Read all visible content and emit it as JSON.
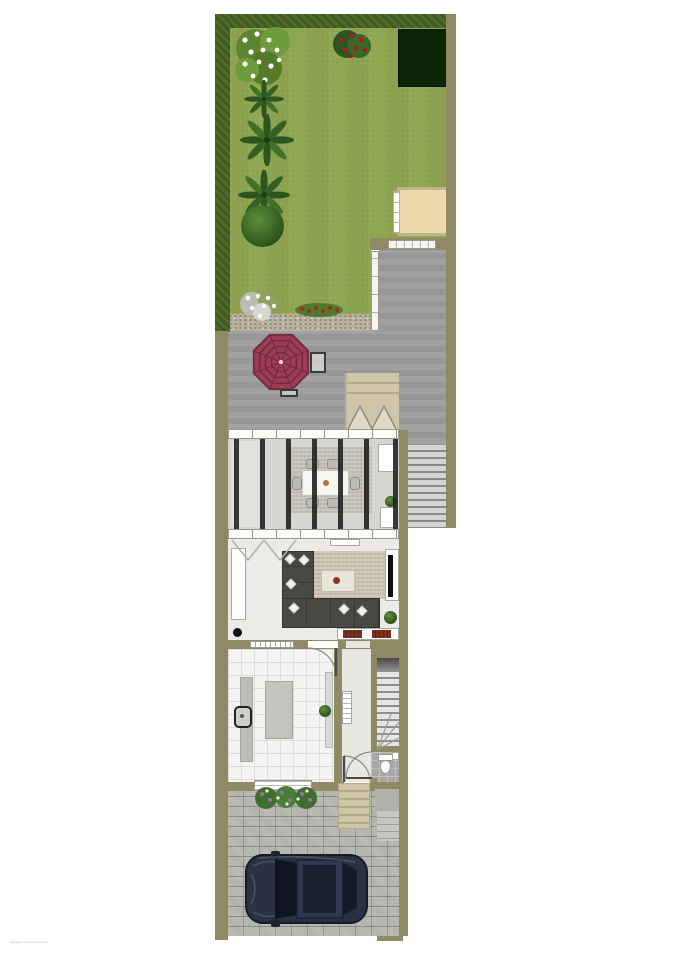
{
  "watermark": "——— —— ————",
  "colors": {
    "wall": "#8f8a63",
    "grass": "#8fa651",
    "hedge": "#4e6b2a",
    "shedDark": "#0e2407",
    "shedBeige": "#ecd9ae",
    "shedBorder": "#c2b389",
    "patio": "#9d9d9f",
    "gravel": "#b9af9d",
    "umbrella": "#9c3c57",
    "umbrellaDark": "#74293f",
    "deck": "#cfc6a9",
    "deckLine": "#b4aa88",
    "floorCons": "#d6d5d1",
    "rafter": "#1c1c1c",
    "rugCons": "#c7c4ba",
    "floorLiving": "#edebe7",
    "rugLiving": "#cfc7b2",
    "sofa": "#4a4845",
    "tableCream": "#eae5da",
    "redItem": "#7e3020",
    "floorKitchen": "#f4f4f2",
    "tileLine": "#dcdcd8",
    "counter": "#bdbdb9",
    "island": "#c3c3bf",
    "floorHall": "#e9e7e2",
    "stairLight": "#e6e6e6",
    "stairDark": "#8f8f8f",
    "wcFloor": "#a8a8a6",
    "cobble": "#b5b5af",
    "cobbleJoint": "#9c9c96",
    "car": "#2a3142",
    "carDark": "#141926",
    "fence": "#f5f5f3",
    "plant": "#4e7f33",
    "flowerRed": "#a32020",
    "flowerPurple": "#9a6fae"
  },
  "scene": {
    "type": "residential-floor-plan-top-view",
    "rooms": [
      "garden",
      "patio",
      "deck",
      "conservatory-dining-room",
      "living-room",
      "kitchen",
      "hallway",
      "staircase",
      "wc",
      "driveway"
    ],
    "objects": [
      "hedge",
      "white-flower-bush",
      "berry-bush",
      "dark-garden-shed",
      "beige-storage-shed",
      "palm-plant",
      "round-bush",
      "white-flowers",
      "red-flowerbed",
      "gravel-path",
      "garden-gate",
      "garden-fence",
      "parasol",
      "patio-table",
      "garden-bench",
      "deck-steps",
      "exterior-stairs",
      "dining-table",
      "dining-chair",
      "dining-rug",
      "sideboard",
      "tv",
      "tv-unit",
      "sofa-sectional",
      "coffee-table",
      "media-shelf",
      "kitchen-island",
      "kitchen-counter",
      "kitchen-sink",
      "radiator",
      "interior-stairs",
      "toilet",
      "front-door",
      "front-steps",
      "flower-planters",
      "car"
    ]
  }
}
